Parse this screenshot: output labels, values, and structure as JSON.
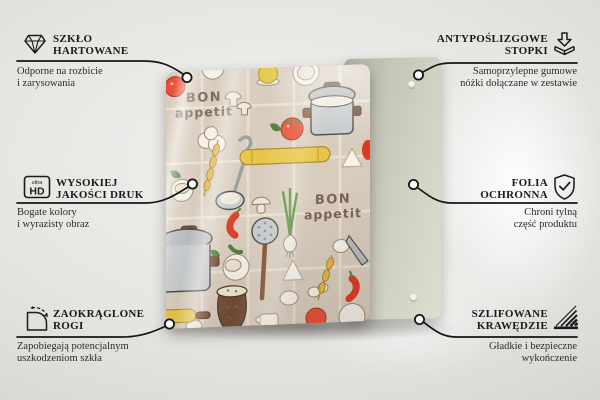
{
  "callouts": [
    {
      "id": "tempered-glass",
      "icon": "diamond-icon",
      "title_1": "SZKŁO",
      "title_2": "HARTOWANE",
      "desc_1": "Odporne na rozbicie",
      "desc_2": "i zarysowania"
    },
    {
      "id": "anti-slip-feet",
      "icon": "adhesive-feet-icon",
      "title_1": "ANTYPOŚLIZGOWE",
      "title_2": "STOPKI",
      "desc_1": "Samoprzylepne gumowe",
      "desc_2": "nóżki dołączane w zestawie"
    },
    {
      "id": "high-quality-print",
      "icon": "ultra-hd-icon",
      "icon_text_1": "ultra",
      "icon_text_2": "HD",
      "title_1": "WYSOKIEJ",
      "title_2": "JAKOŚCI DRUK",
      "desc_1": "Bogate kolory",
      "desc_2": "i wyrazisty obraz"
    },
    {
      "id": "protective-film",
      "icon": "shield-check-icon",
      "title_1": "FOLIA",
      "title_2": "OCHRONNA",
      "desc_1": "Chroni tylną",
      "desc_2": "część produktu"
    },
    {
      "id": "rounded-corners",
      "icon": "rounded-corner-icon",
      "title_1": "ZAOKRĄGLONE",
      "title_2": "ROGI",
      "desc_1": "Zapobiegają potencjalnym",
      "desc_2": "uszkodzeniom szkła"
    },
    {
      "id": "polished-edges",
      "icon": "hatched-edge-icon",
      "title_1": "SZLIFOWANE",
      "title_2": "KRAWĘDZIE",
      "desc_1": "Gładkie i bezpieczne",
      "desc_2": "wykończenie"
    }
  ],
  "product": {
    "board_text_1": {
      "line1": "BON",
      "line2": "appetit"
    },
    "board_text_2": {
      "line1": "BON",
      "line2": "appetit"
    },
    "colors": {
      "glass_background": "#d8ccbd",
      "back_panel": "#cdcfc0",
      "accent_red": "#e85038",
      "accent_yellow": "#e7c647",
      "pot_gray": "#c6c9cb",
      "board_text_brown": "#7c6357",
      "connector_line": "#161616"
    }
  }
}
